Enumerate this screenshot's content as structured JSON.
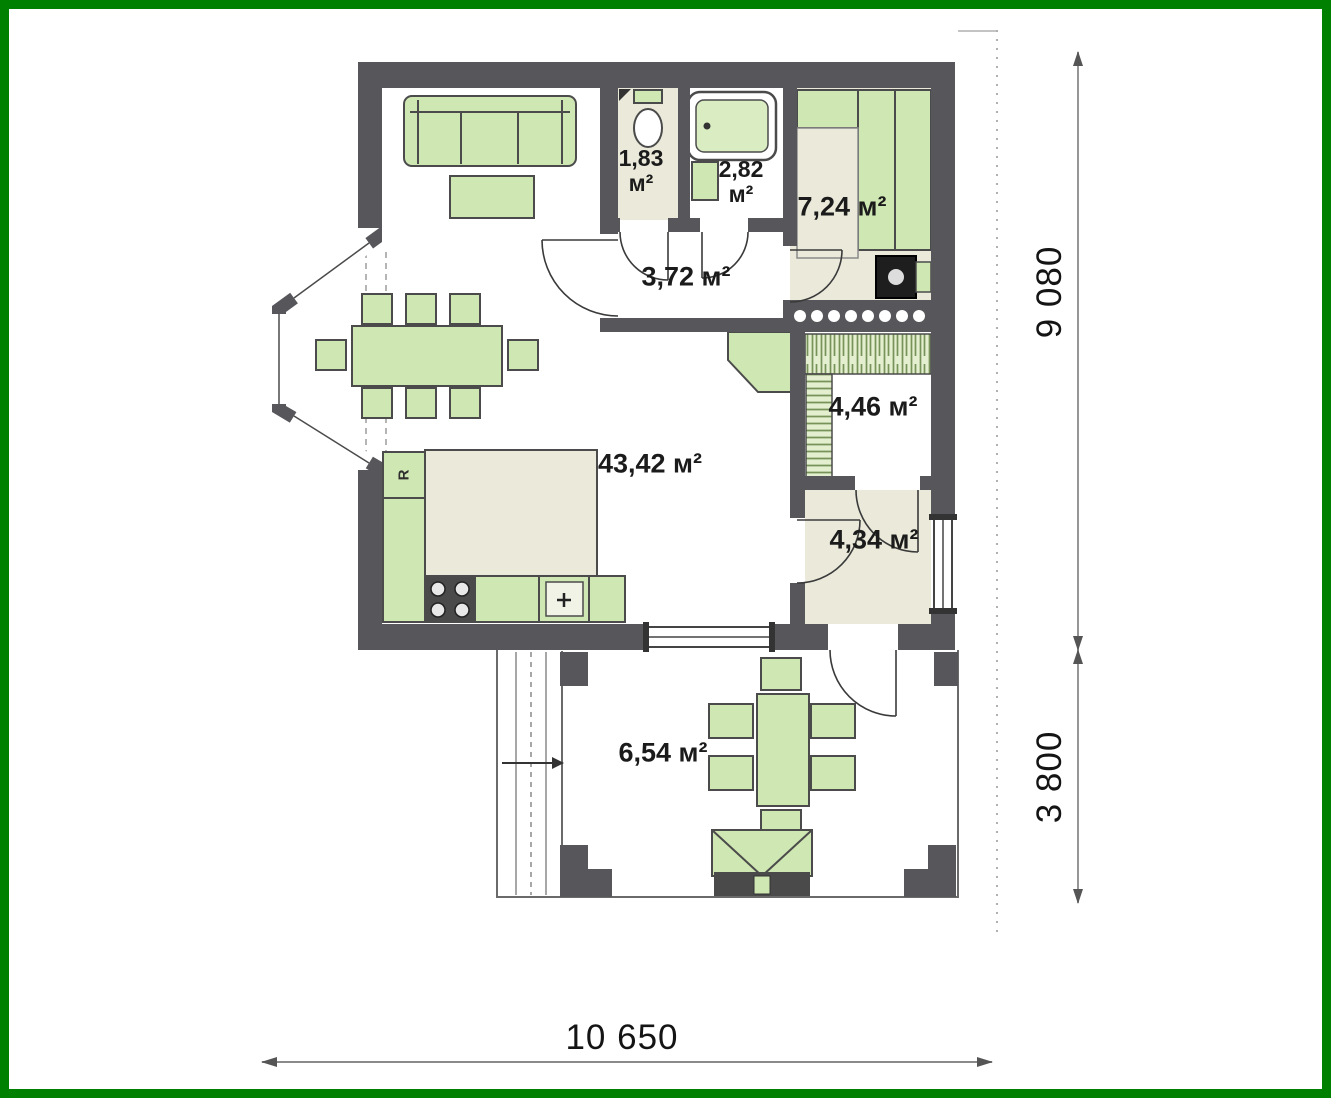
{
  "plan": {
    "rooms": {
      "wc": {
        "value": "1,83",
        "unit": "м²"
      },
      "bathroom": {
        "value": "2,82",
        "unit": "м²"
      },
      "bedroom": {
        "label": "7,24 м²"
      },
      "hall": {
        "label": "3,72 м²"
      },
      "storage": {
        "label": "4,46 м²"
      },
      "entry": {
        "label": "4,34 м²"
      },
      "living_kitchen": {
        "label": "43,42 м²"
      },
      "terrace": {
        "label": "6,54 м²"
      }
    },
    "appliances": {
      "fridge_label": "R"
    },
    "dimensions": {
      "overall_width": "10 650",
      "main_depth": "9 080",
      "terrace_depth": "3 800"
    },
    "colors": {
      "frame": "#008000",
      "wall": "#57565a",
      "furniture_green": "#cfe7b2",
      "floor_beige": "#eae9da"
    }
  }
}
